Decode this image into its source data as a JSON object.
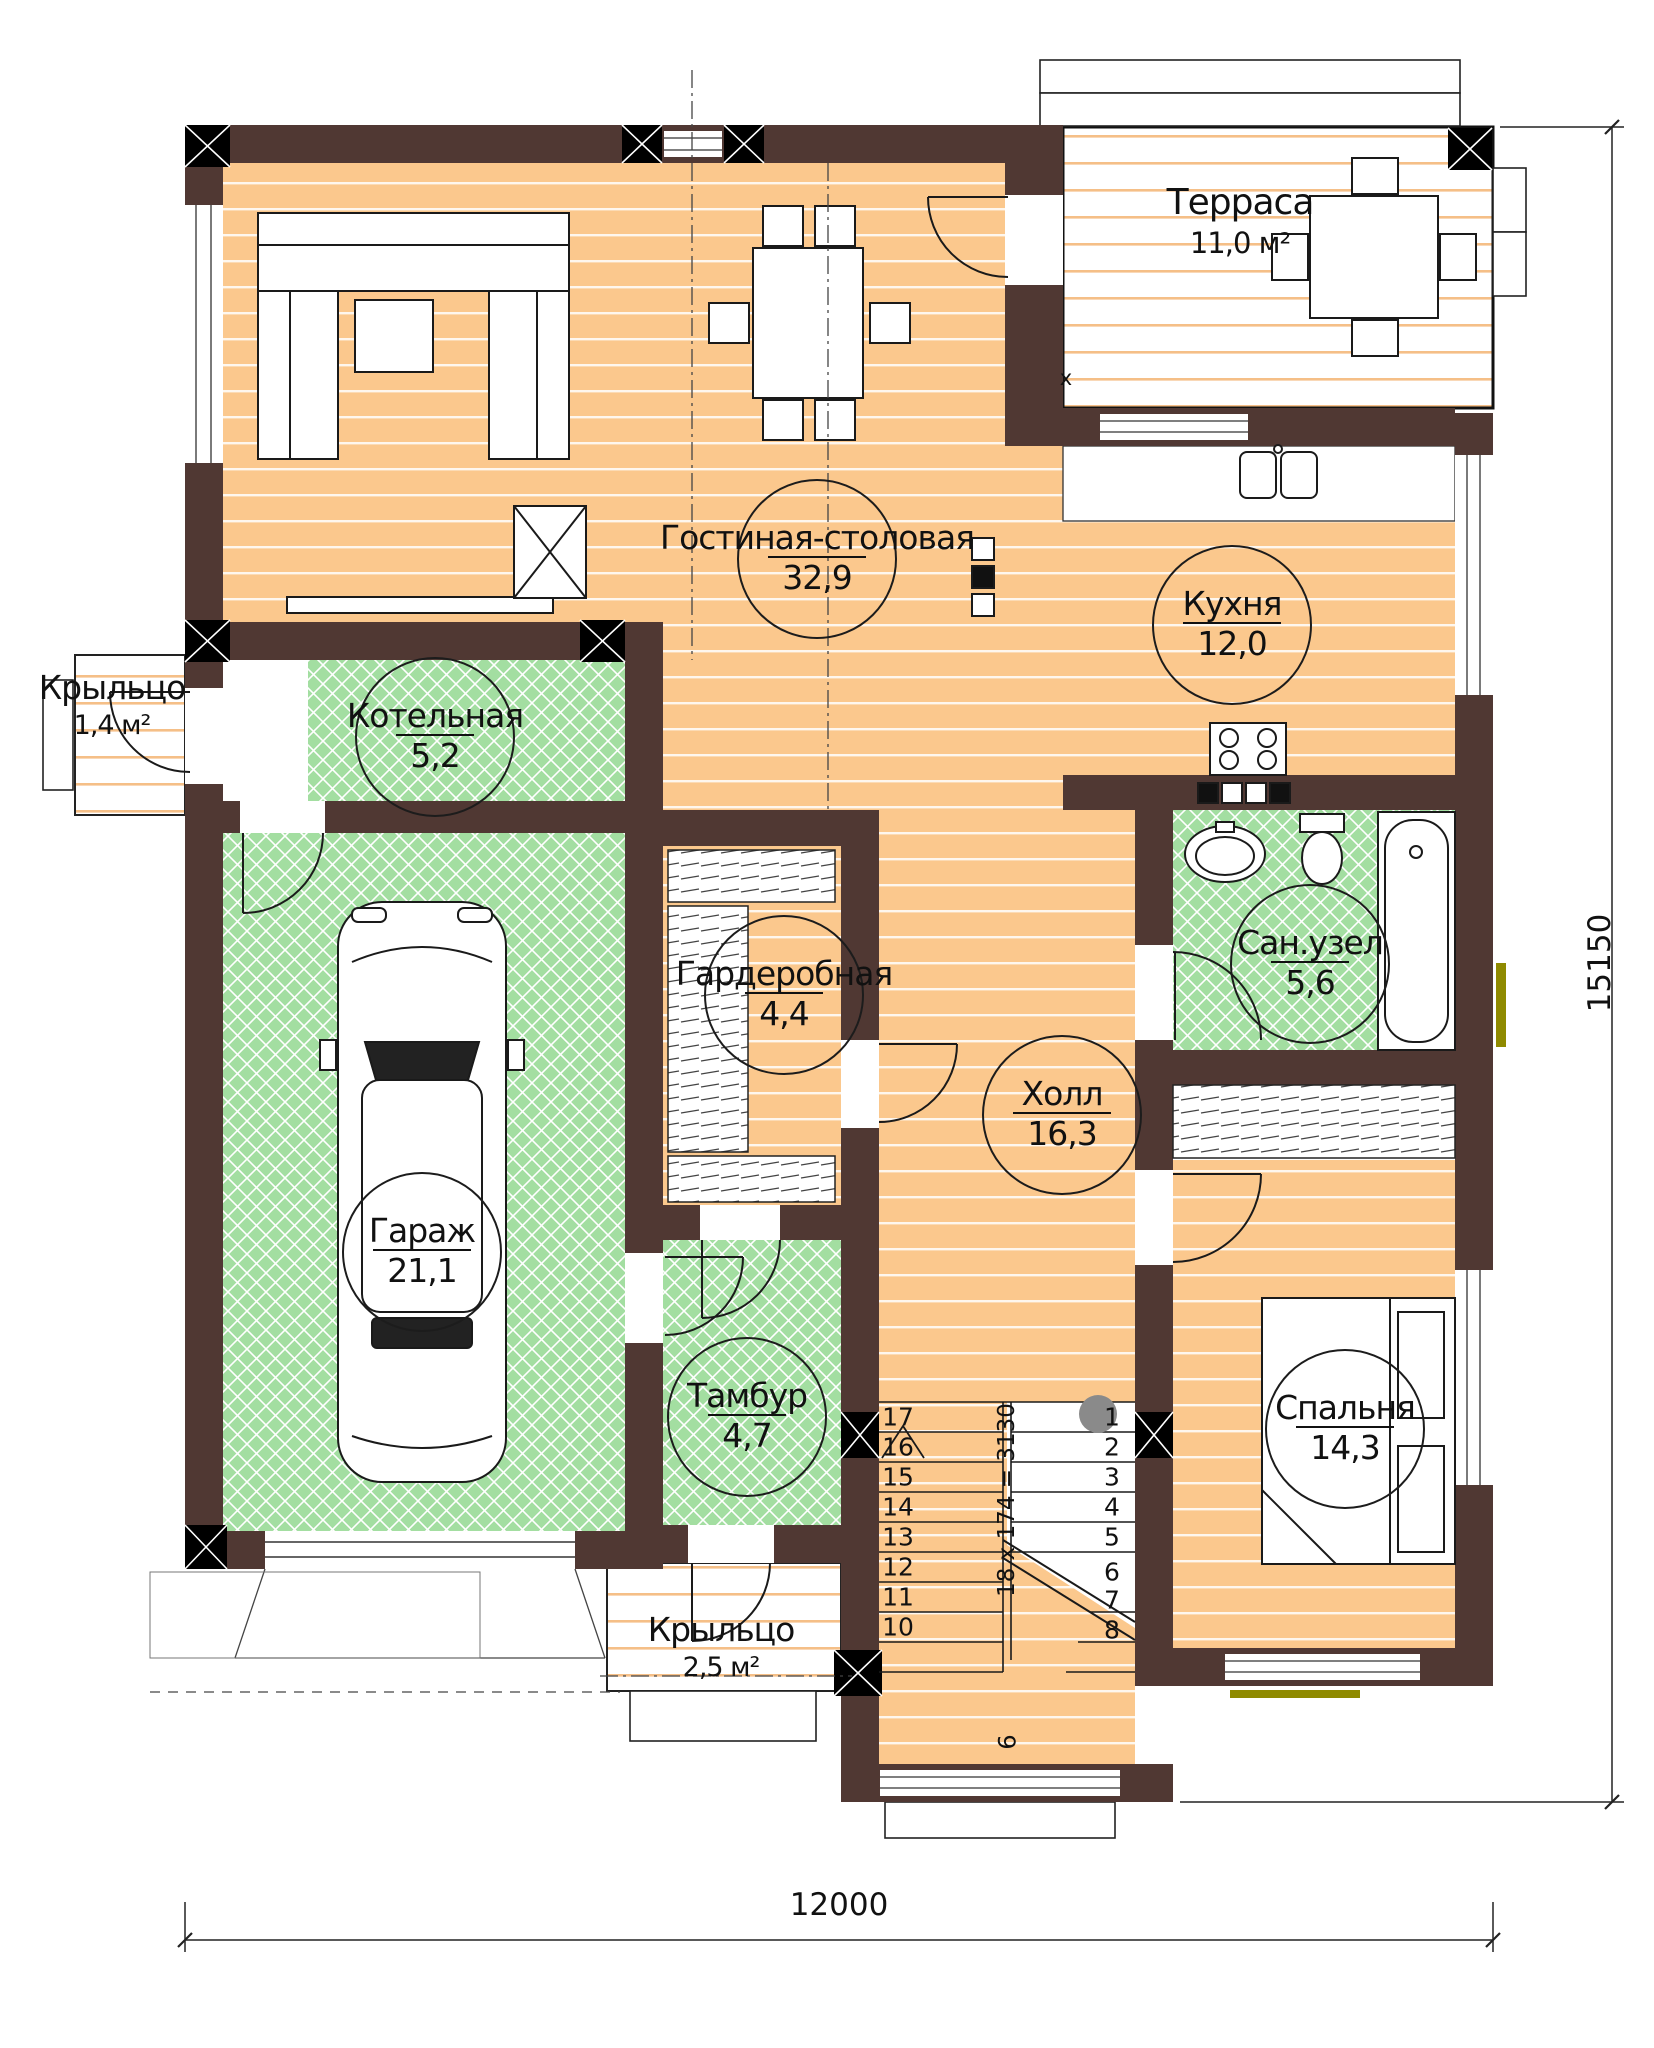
{
  "rooms": [
    {
      "id": "living",
      "name": "Гостиная-столовая",
      "area": "32,9"
    },
    {
      "id": "kitchen",
      "name": "Кухня",
      "area": "12,0"
    },
    {
      "id": "boiler",
      "name": "Котельная",
      "area": "5,2"
    },
    {
      "id": "wardrobe",
      "name": "Гардеробная",
      "area": "4,4"
    },
    {
      "id": "bathroom",
      "name": "Сан.узел",
      "area": "5,6"
    },
    {
      "id": "hall",
      "name": "Холл",
      "area": "16,3"
    },
    {
      "id": "garage",
      "name": "Гараж",
      "area": "21,1"
    },
    {
      "id": "bedroom",
      "name": "Спальня",
      "area": "14,3"
    },
    {
      "id": "vestibule",
      "name": "Тамбур",
      "area": "4,7"
    },
    {
      "id": "terrace",
      "name": "Терраса",
      "area": "11,0 м²"
    },
    {
      "id": "porch-left",
      "name": "Крыльцо",
      "area": "1,4 м²"
    },
    {
      "id": "porch-bottom",
      "name": "Крыльцо",
      "area": "2,5 м²"
    }
  ],
  "stairs": {
    "left": [
      "17",
      "16",
      "15",
      "14",
      "13",
      "12",
      "11",
      "10"
    ],
    "right": [
      "1",
      "2",
      "3",
      "4",
      "5",
      "6",
      "7",
      "8"
    ],
    "mid": "9",
    "formula": "18 x 174 = 3130"
  },
  "dimensions": {
    "width_mm": "12000",
    "height_mm": "15150"
  },
  "markers": {
    "vent": "х"
  },
  "colors": {
    "wall": "#503833",
    "floor": "#FBC88D",
    "floor_stripe": "#FFFFFF",
    "green": "#A3DEA1",
    "terrace_stripe": "#F5BF87",
    "olive_window_mark": "#8F8A00",
    "stair_post_gray": "#8A8A8A"
  }
}
